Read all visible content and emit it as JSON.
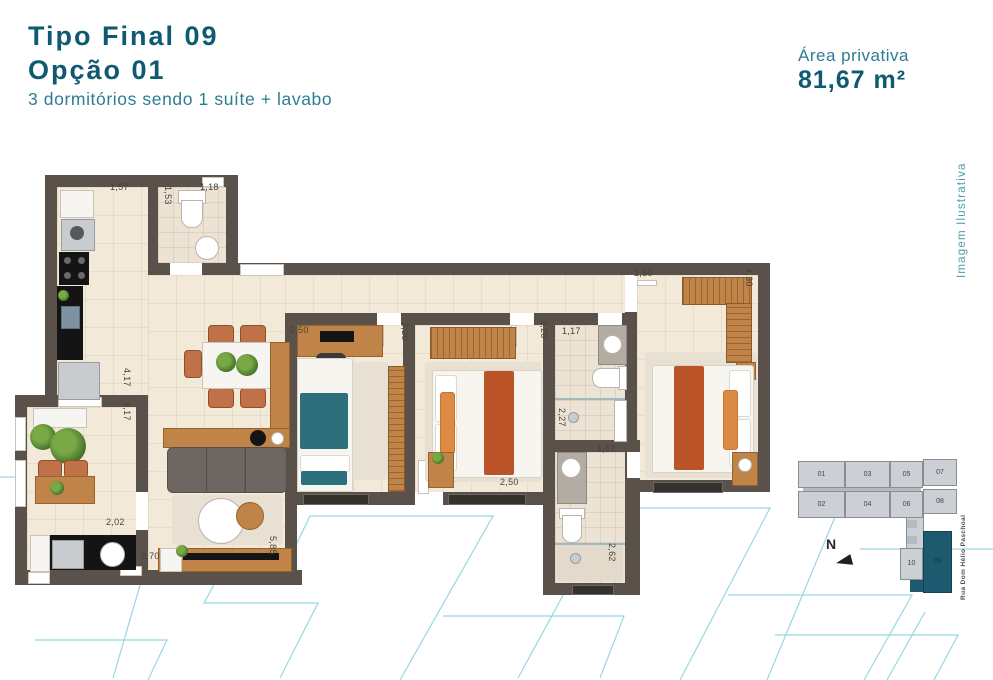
{
  "header": {
    "title_line1": "Tipo Final 09",
    "title_line2": "Opção 01",
    "subtitle": "3 dormitórios sendo 1 suíte + lavabo"
  },
  "area": {
    "label": "Área privativa",
    "value": "81,67 m²"
  },
  "watermark": "Imagem Ilustrativa",
  "floorplan": {
    "dimensions": [
      {
        "text": "1,57",
        "x": 110,
        "y": 182
      },
      {
        "text": "1,53",
        "x": 163,
        "y": 186,
        "v": true
      },
      {
        "text": "1,18",
        "x": 200,
        "y": 182
      },
      {
        "text": "4,17",
        "x": 122,
        "y": 368,
        "v": true
      },
      {
        "text": "3,17",
        "x": 122,
        "y": 402,
        "v": true
      },
      {
        "text": "2,02",
        "x": 106,
        "y": 517
      },
      {
        "text": "2,70",
        "x": 141,
        "y": 551
      },
      {
        "text": "5,85",
        "x": 268,
        "y": 536,
        "v": true
      },
      {
        "text": "2,50",
        "x": 290,
        "y": 325
      },
      {
        "text": "3,20",
        "x": 400,
        "y": 322,
        "v": true
      },
      {
        "text": "3,20",
        "x": 539,
        "y": 320,
        "v": true
      },
      {
        "text": "1,17",
        "x": 562,
        "y": 326
      },
      {
        "text": "2,27",
        "x": 557,
        "y": 408,
        "v": true
      },
      {
        "text": "2,50",
        "x": 634,
        "y": 268
      },
      {
        "text": "4,30",
        "x": 744,
        "y": 268,
        "v": true
      },
      {
        "text": "2,50",
        "x": 500,
        "y": 477
      },
      {
        "text": "1,17",
        "x": 597,
        "y": 444
      },
      {
        "text": "2,62",
        "x": 607,
        "y": 543,
        "v": true
      }
    ]
  },
  "keyplan": {
    "street": "Rua Dom Hélio Paschoal",
    "north_label": "N",
    "highlighted_unit": "09",
    "units": [
      {
        "id": "01",
        "x": 798,
        "y": 461,
        "w": 47,
        "h": 27
      },
      {
        "id": "03",
        "x": 845,
        "y": 461,
        "w": 45,
        "h": 27
      },
      {
        "id": "05",
        "x": 890,
        "y": 461,
        "w": 33,
        "h": 27
      },
      {
        "id": "07",
        "x": 923,
        "y": 459,
        "w": 34,
        "h": 27
      },
      {
        "id": "02",
        "x": 798,
        "y": 491,
        "w": 47,
        "h": 27
      },
      {
        "id": "04",
        "x": 845,
        "y": 491,
        "w": 45,
        "h": 27
      },
      {
        "id": "06",
        "x": 890,
        "y": 491,
        "w": 33,
        "h": 27
      },
      {
        "id": "08",
        "x": 923,
        "y": 489,
        "w": 34,
        "h": 25
      },
      {
        "id": "10",
        "x": 900,
        "y": 548,
        "w": 23,
        "h": 32
      },
      {
        "id": "09",
        "x": 923,
        "y": 531,
        "w": 29,
        "h": 62,
        "hl": true
      }
    ]
  },
  "colors": {
    "accent_teal_dark": "#0f5a72",
    "accent_teal_light": "#2d7d92",
    "wall": "#59514a",
    "floor": "#f3e9d9",
    "pattern_blue": "#97d7e2",
    "keyplan_highlight": "#1d5a70"
  }
}
